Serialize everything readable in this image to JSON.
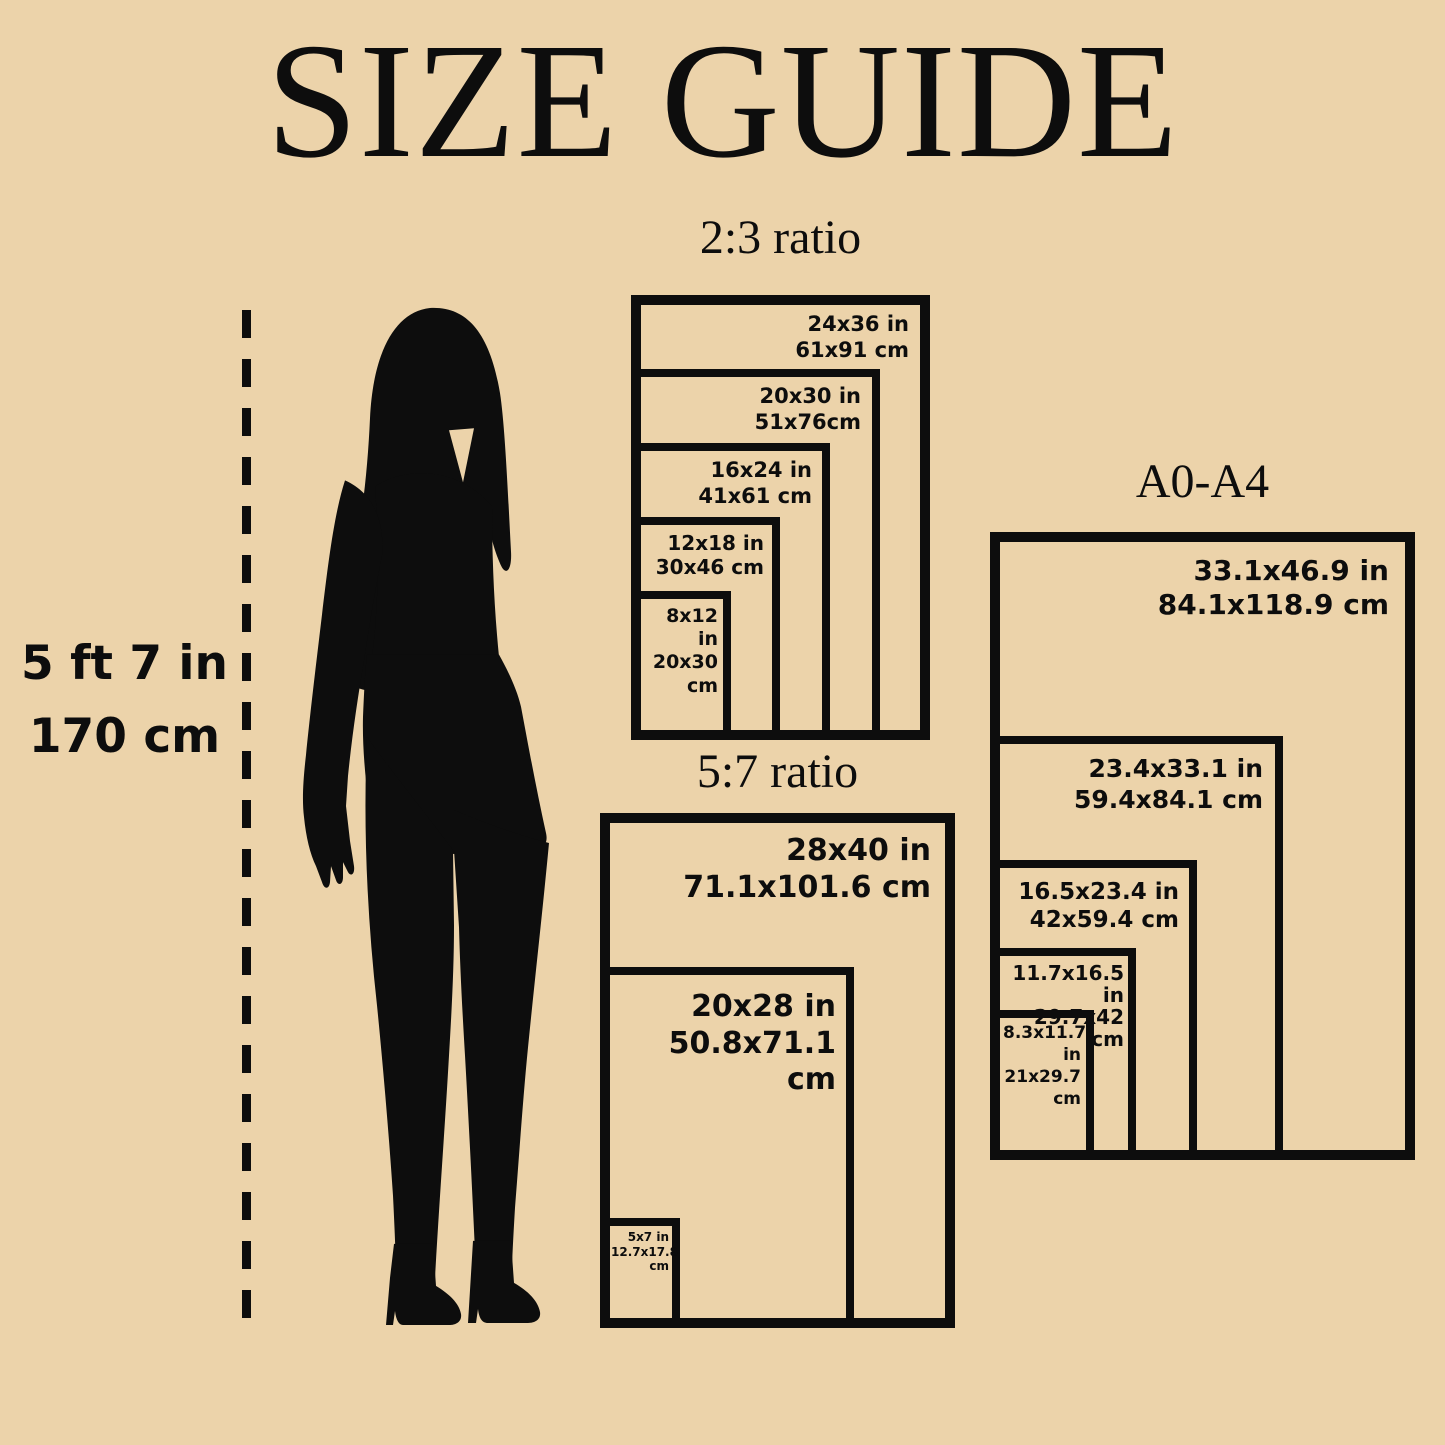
{
  "title": "SIZE GUIDE",
  "colors": {
    "background": "#ecd3aa",
    "ink": "#0d0d0d"
  },
  "height_label": {
    "line1": "5 ft 7 in",
    "line2": "170 cm"
  },
  "figure": {
    "icon": "woman-silhouette",
    "reference_line": "dashed-height-line"
  },
  "groups": [
    {
      "heading": "2:3 ratio",
      "sizes": [
        {
          "inch": "24x36 in",
          "cm": "61x91 cm"
        },
        {
          "inch": "20x30 in",
          "cm": "51x76cm"
        },
        {
          "inch": "16x24 in",
          "cm": "41x61 cm"
        },
        {
          "inch": "12x18 in",
          "cm": "30x46 cm"
        },
        {
          "inch": "8x12 in",
          "cm": "20x30 cm"
        }
      ]
    },
    {
      "heading": "5:7 ratio",
      "sizes": [
        {
          "inch": "28x40 in",
          "cm": "71.1x101.6 cm"
        },
        {
          "inch": "20x28 in",
          "cm": "50.8x71.1 cm"
        },
        {
          "inch": "5x7 in",
          "cm": "12.7x17.8 cm"
        }
      ]
    },
    {
      "heading": "A0-A4",
      "sizes": [
        {
          "inch": "33.1x46.9 in",
          "cm": "84.1x118.9 cm"
        },
        {
          "inch": "23.4x33.1 in",
          "cm": "59.4x84.1 cm"
        },
        {
          "inch": "16.5x23.4 in",
          "cm": "42x59.4 cm"
        },
        {
          "inch": "11.7x16.5 in",
          "cm": "29.7x42 cm"
        },
        {
          "inch": "8.3x11.7 in",
          "cm": "21x29.7 cm"
        }
      ]
    }
  ]
}
